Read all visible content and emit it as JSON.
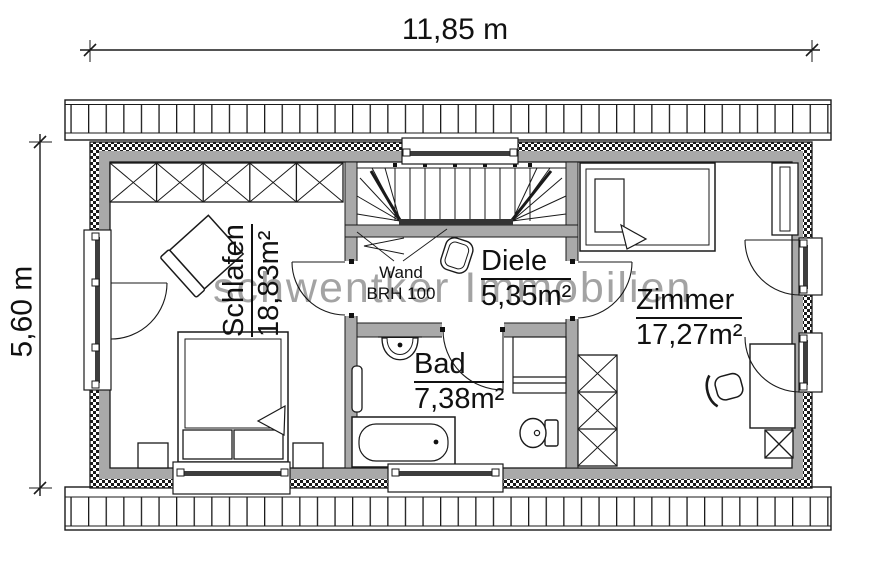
{
  "plan": {
    "watermark": "schwentker Immobilien",
    "dim_width": "11,85 m",
    "dim_height": "5,60 m",
    "rooms": [
      {
        "name": "Schlafen",
        "area": "18,83m²"
      },
      {
        "name": "Diele",
        "area": "5,35m²"
      },
      {
        "name": "Bad",
        "area": "7,38m²"
      },
      {
        "name": "Zimmer",
        "area": "17,27m²"
      }
    ],
    "note": {
      "line1": "Wand",
      "line2": "BRH 100"
    },
    "colors": {
      "wall_gray": "#a9a9a9",
      "line": "#1a1a1a",
      "glazing": "#3d3d3d",
      "watermark_gray": "#a2a2a2"
    },
    "symbols": [
      "staircase",
      "double-bed",
      "single-bed",
      "wardrobe",
      "bathtub",
      "sink",
      "toilet",
      "desk",
      "chair",
      "radiator",
      "laundry-basket",
      "storage-box",
      "window",
      "door-swing",
      "roof-overhang"
    ]
  }
}
